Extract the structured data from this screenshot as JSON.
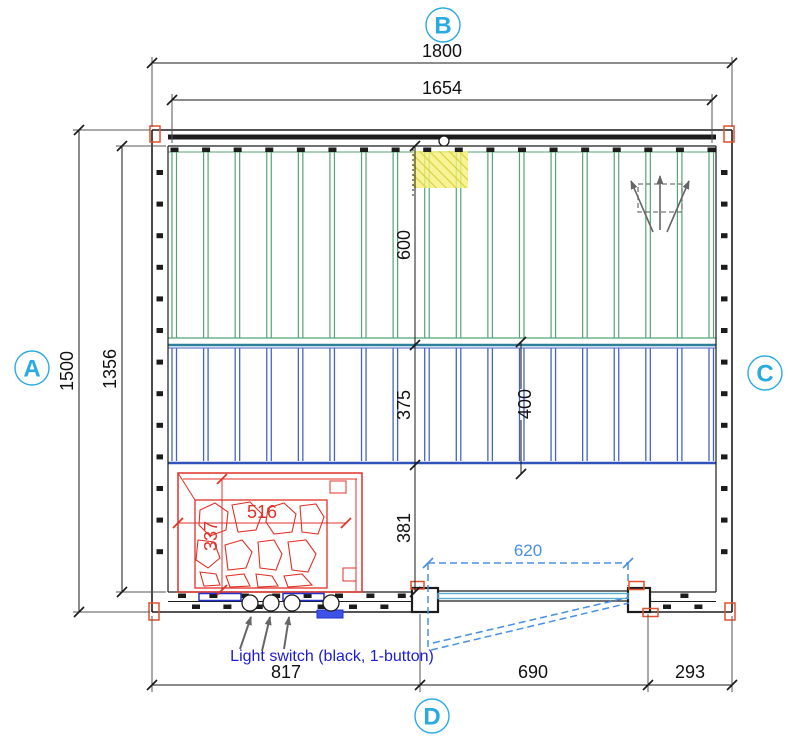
{
  "drawing": {
    "view_markers": {
      "top": "B",
      "left": "A",
      "right": "C",
      "bottom": "D"
    },
    "dimensions": {
      "outer_width": "1800",
      "inner_width": "1654",
      "outer_depth": "1500",
      "inner_depth": "1356",
      "upper_bench_depth": "600",
      "lower_bench_boards": "375",
      "lower_bench_total": "400",
      "floor_gap": "381",
      "heater_width": "516",
      "heater_depth": "337",
      "door_glass_width": "620",
      "bottom_seg_left": "817",
      "bottom_seg_door": "690",
      "bottom_seg_right": "293"
    },
    "annotations": {
      "light_switch": "Light switch (black, 1-button)"
    },
    "benches": {
      "upper_board_count": 18,
      "lower_board_count": 18
    },
    "colors": {
      "marker_cyan": "#29ABE2",
      "annotation_blue": "#1C1CD6",
      "door_dash_blue": "#4A90E2",
      "glass_blue": "#57AFD4",
      "bench_green": "#55A476",
      "bench_divider_teal": "#2E7F99",
      "bench_blue": "#4463C6",
      "bench_blue_edge": "#3152BB",
      "heater_red": "#E03127",
      "highlight_yellow": "#F6F17C",
      "hatch_yellow": "#D8CE3E",
      "corner_red": "#E0512F",
      "arrow_gray": "#666666",
      "dim_black": "#1A1A1A",
      "ext_gray": "#555555",
      "wall_black": "#1C1C1C"
    }
  }
}
